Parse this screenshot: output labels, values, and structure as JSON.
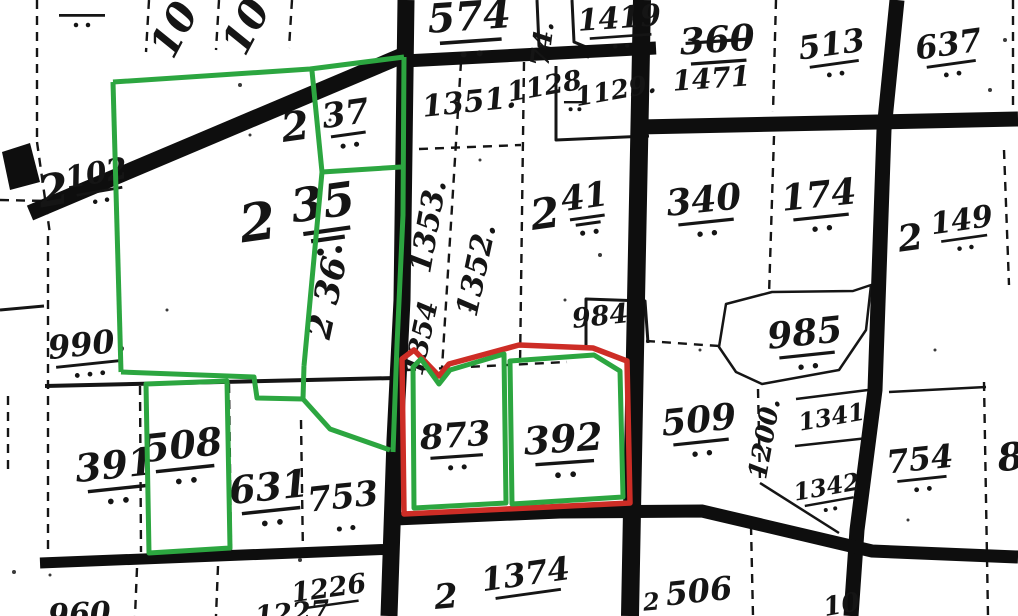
{
  "map": {
    "background": "#ffffff",
    "ink": "#151515",
    "road_color": "#0e0e0e",
    "green": "#2CA640",
    "red": "#CD2D26",
    "labels": [
      {
        "t": "",
        "x": 82,
        "y": 7,
        "fs": 30,
        "rot": 0,
        "u": 1,
        "d": 2,
        "ulw": 50
      },
      {
        "t": "10",
        "x": 186,
        "y": 36,
        "fs": 40,
        "rot": -62,
        "u": 0,
        "d": 0
      },
      {
        "t": "10",
        "x": 258,
        "y": 33,
        "fs": 40,
        "rot": -62,
        "u": 0,
        "d": 0
      },
      {
        "t": "574",
        "x": 470,
        "y": 30,
        "fs": 40,
        "rot": -4,
        "u": 1,
        "d": 2
      },
      {
        "t": "74.",
        "x": 551,
        "y": 45,
        "fs": 26,
        "rot": -83,
        "u": 0,
        "d": 0
      },
      {
        "t": "1419",
        "x": 620,
        "y": 28,
        "fs": 30,
        "rot": -4,
        "u": 1,
        "d": 2
      },
      {
        "t": "360",
        "x": 718,
        "y": 52,
        "fs": 36,
        "rot": -4,
        "u": 1,
        "d": 0,
        "strike": 1
      },
      {
        "t": "1471",
        "x": 712,
        "y": 88,
        "fs": 28,
        "rot": -4,
        "u": 0,
        "d": 0
      },
      {
        "t": "513",
        "x": 833,
        "y": 55,
        "fs": 32,
        "rot": -8,
        "u": 1,
        "d": 2
      },
      {
        "t": "637",
        "x": 950,
        "y": 55,
        "fs": 32,
        "rot": -8,
        "u": 1,
        "d": 2
      },
      {
        "t": "2",
        "x": 56,
        "y": 205,
        "fs": 44,
        "rot": -10,
        "u": 0,
        "d": 0
      },
      {
        "t": "102",
        "x": 98,
        "y": 183,
        "fs": 30,
        "rot": -10,
        "u": 1,
        "d": 2
      },
      {
        "t": "2",
        "x": 260,
        "y": 240,
        "fs": 52,
        "rot": -8,
        "u": 0,
        "d": 0
      },
      {
        "t": "35",
        "x": 325,
        "y": 218,
        "fs": 46,
        "rot": -8,
        "u": 2,
        "d": 2
      },
      {
        "t": "2",
        "x": 297,
        "y": 140,
        "fs": 40,
        "rot": -8,
        "u": 0,
        "d": 0
      },
      {
        "t": "37",
        "x": 347,
        "y": 125,
        "fs": 34,
        "rot": -8,
        "u": 1,
        "d": 2
      },
      {
        "t": "2 36",
        "x": 338,
        "y": 300,
        "fs": 34,
        "rot": -78,
        "u": 0,
        "d": 0
      },
      {
        "t": "1351.",
        "x": 470,
        "y": 112,
        "fs": 30,
        "rot": -6,
        "u": 0,
        "d": 0
      },
      {
        "t": "1128",
        "x": 546,
        "y": 95,
        "fs": 27,
        "rot": -10,
        "u": 0,
        "d": 0
      },
      {
        "t": "",
        "x": 575,
        "y": 96,
        "fs": 22,
        "rot": 0,
        "u": 1,
        "d": 2,
        "ulw": 24
      },
      {
        "t": "1129.",
        "x": 617,
        "y": 99,
        "fs": 26,
        "rot": -10,
        "u": 0,
        "d": 0
      },
      {
        "t": "1353.",
        "x": 438,
        "y": 228,
        "fs": 30,
        "rot": -80,
        "u": 0,
        "d": 0
      },
      {
        "t": "1352.",
        "x": 486,
        "y": 272,
        "fs": 30,
        "rot": -78,
        "u": 0,
        "d": 0
      },
      {
        "t": "1354",
        "x": 430,
        "y": 340,
        "fs": 27,
        "rot": -78,
        "u": 0,
        "d": 0
      },
      {
        "t": "2",
        "x": 547,
        "y": 228,
        "fs": 42,
        "rot": -8,
        "u": 0,
        "d": 0
      },
      {
        "t": "41",
        "x": 586,
        "y": 208,
        "fs": 34,
        "rot": -8,
        "u": 2,
        "d": 2
      },
      {
        "t": "340",
        "x": 705,
        "y": 212,
        "fs": 36,
        "rot": -6,
        "u": 1,
        "d": 2
      },
      {
        "t": "174",
        "x": 820,
        "y": 207,
        "fs": 36,
        "rot": -6,
        "u": 1,
        "d": 2
      },
      {
        "t": "2",
        "x": 912,
        "y": 250,
        "fs": 36,
        "rot": -8,
        "u": 0,
        "d": 0
      },
      {
        "t": "149",
        "x": 963,
        "y": 230,
        "fs": 30,
        "rot": -8,
        "u": 1,
        "d": 2
      },
      {
        "t": "984",
        "x": 601,
        "y": 325,
        "fs": 27,
        "rot": -6,
        "u": 0,
        "d": 0
      },
      {
        "t": "985",
        "x": 806,
        "y": 345,
        "fs": 36,
        "rot": -6,
        "u": 1,
        "d": 2
      },
      {
        "t": "990.",
        "x": 88,
        "y": 355,
        "fs": 32,
        "rot": -6,
        "u": 1,
        "d": 3
      },
      {
        "t": "509",
        "x": 700,
        "y": 432,
        "fs": 36,
        "rot": -6,
        "u": 1,
        "d": 2
      },
      {
        "t": "1200.",
        "x": 773,
        "y": 440,
        "fs": 26,
        "rot": -80,
        "u": 0,
        "d": 0
      },
      {
        "t": "1341",
        "x": 833,
        "y": 425,
        "fs": 24,
        "rot": -10,
        "u": 0,
        "d": 0
      },
      {
        "t": "1342",
        "x": 828,
        "y": 495,
        "fs": 24,
        "rot": -10,
        "u": 1,
        "d": 2
      },
      {
        "t": "754",
        "x": 921,
        "y": 470,
        "fs": 32,
        "rot": -6,
        "u": 1,
        "d": 2
      },
      {
        "t": "8",
        "x": 1012,
        "y": 470,
        "fs": 38,
        "rot": -6,
        "u": 0,
        "d": 0
      },
      {
        "t": "391",
        "x": 116,
        "y": 478,
        "fs": 38,
        "rot": -6,
        "u": 1,
        "d": 2
      },
      {
        "t": "508",
        "x": 184,
        "y": 458,
        "fs": 38,
        "rot": -6,
        "u": 1,
        "d": 2
      },
      {
        "t": "631",
        "x": 270,
        "y": 500,
        "fs": 38,
        "rot": -6,
        "u": 1,
        "d": 2
      },
      {
        "t": "753",
        "x": 344,
        "y": 508,
        "fs": 34,
        "rot": -6,
        "u": 0,
        "d": 2
      },
      {
        "t": "873",
        "x": 456,
        "y": 447,
        "fs": 34,
        "rot": -4,
        "u": 1,
        "d": 2
      },
      {
        "t": "392",
        "x": 564,
        "y": 452,
        "fs": 38,
        "rot": -4,
        "u": 1,
        "d": 2
      },
      {
        "t": "1226",
        "x": 330,
        "y": 597,
        "fs": 27,
        "rot": -8,
        "u": 1,
        "d": 0
      },
      {
        "t": "1227",
        "x": 293,
        "y": 622,
        "fs": 27,
        "rot": -5,
        "u": 0,
        "d": 0
      },
      {
        "t": "960",
        "x": 80,
        "y": 624,
        "fs": 30,
        "rot": -3,
        "u": 0,
        "d": 0
      },
      {
        "t": "2",
        "x": 447,
        "y": 608,
        "fs": 34,
        "rot": -5,
        "u": 0,
        "d": 0
      },
      {
        "t": "1374",
        "x": 527,
        "y": 585,
        "fs": 32,
        "rot": -8,
        "u": 1,
        "d": 0
      },
      {
        "t": "2",
        "x": 652,
        "y": 610,
        "fs": 24,
        "rot": -5,
        "u": 0,
        "d": 0
      },
      {
        "t": "506",
        "x": 700,
        "y": 602,
        "fs": 32,
        "rot": -6,
        "u": 0,
        "d": 0
      },
      {
        "t": "10",
        "x": 843,
        "y": 613,
        "fs": 26,
        "rot": -10,
        "u": 0,
        "d": 0
      }
    ],
    "roads": [
      {
        "d": "M30,213 L406,54",
        "w": 16
      },
      {
        "d": "M406,0 L402,300 L395,440 L389,616",
        "w": 17
      },
      {
        "d": "M642,0 L636,300 L630,616",
        "w": 18
      },
      {
        "d": "M897,0 L884,130 L875,390 L857,530 L851,616",
        "w": 15
      },
      {
        "d": "M404,61 L656,48",
        "w": 13
      },
      {
        "d": "M639,127 L1018,119",
        "w": 15
      },
      {
        "d": "M395,519 L560,512 L702,511 L872,551 L1018,557",
        "w": 13
      },
      {
        "d": "M40,563 L396,549",
        "w": 11
      }
    ],
    "blobs": [
      {
        "d": "M2,152 L30,143 L40,182 L10,190 Z"
      }
    ],
    "solids": [
      {
        "d": "M45,386 L395,378",
        "w": 4
      },
      {
        "d": "M537,0 L539,46 L589,57",
        "w": 3
      },
      {
        "d": "M572,0 L574,42 L591,49",
        "w": 3
      },
      {
        "d": "M556,66 L556,140 L649,136",
        "w": 3
      },
      {
        "d": "M586,345 L586,299 L645,301 L648,343",
        "w": 3
      },
      {
        "d": "M719,347 L726,304 L772,292 L853,291 L871,285 L866,330 L839,370 L762,384 L736,372 Z",
        "w": 2.5
      },
      {
        "d": "M889,392 L986,387",
        "w": 2.5
      },
      {
        "d": "M795,446 L868,438",
        "w": 2.5
      },
      {
        "d": "M760,483 L839,533",
        "w": 2.5
      },
      {
        "d": "M868,390 L796,399",
        "w": 2.5
      },
      {
        "d": "M0,310 L44,306",
        "w": 3
      }
    ],
    "dashed": [
      {
        "d": "M149,0 L146,52"
      },
      {
        "d": "M219,0 L216,50"
      },
      {
        "d": "M292,0 L289,48"
      },
      {
        "d": "M37,0 L37,142"
      },
      {
        "d": "M37,142 L50,234"
      },
      {
        "d": "M48,236 L48,556"
      },
      {
        "d": "M140,386 L141,552"
      },
      {
        "d": "M229,384 L231,550"
      },
      {
        "d": "M301,420 L303,556"
      },
      {
        "d": "M137,568 L135,616"
      },
      {
        "d": "M218,566 L216,616"
      },
      {
        "d": "M419,149 L521,145"
      },
      {
        "d": "M461,62 L442,368"
      },
      {
        "d": "M524,62 L520,366"
      },
      {
        "d": "M407,370 L567,362"
      },
      {
        "d": "M776,0 L773,112"
      },
      {
        "d": "M1013,0 L1013,112"
      },
      {
        "d": "M774,136 L769,295"
      },
      {
        "d": "M646,341 L719,346"
      },
      {
        "d": "M1004,150 L1009,285"
      },
      {
        "d": "M984,382 L988,616"
      },
      {
        "d": "M758,389 L760,482"
      },
      {
        "d": "M751,526 L753,616"
      },
      {
        "d": "M8,396 L8,470"
      },
      {
        "d": "M0,200 L47,201"
      }
    ],
    "greens": [
      {
        "d": "M113,82 L310,69 L404,57"
      },
      {
        "d": "M404,57 L403,215 L397,345 L393,452"
      },
      {
        "d": "M312,71 L322,172"
      },
      {
        "d": "M322,172 L401,167"
      },
      {
        "d": "M322,172 L304,366"
      },
      {
        "d": "M113,82 L121,372"
      },
      {
        "d": "M121,372 L254,377 L257,398 L303,399 L304,366"
      },
      {
        "d": "M303,399 L330,429 L390,450"
      },
      {
        "d": "M146,384 L227,381 L230,548 L149,553 Z"
      },
      {
        "d": "M414,508 L413,367 L421,359 L439,384 L450,370 L504,354 L506,503 Z"
      },
      {
        "d": "M512,504 L510,361 L594,355 L620,371 L623,497 Z"
      }
    ],
    "reds": [
      {
        "d": "M404,514 L402,359 L414,350 L439,376 L449,364 L519,345 L593,348 L627,361 L630,503 Z"
      }
    ],
    "specks": [
      [
        240,
        85,
        2
      ],
      [
        600,
        255,
        2
      ],
      [
        480,
        160,
        1.5
      ],
      [
        300,
        560,
        2
      ],
      [
        50,
        575,
        1.5
      ],
      [
        990,
        90,
        2
      ],
      [
        470,
        310,
        1.5
      ],
      [
        700,
        350,
        1.5
      ],
      [
        14,
        572,
        2
      ],
      [
        330,
        120,
        1.5
      ],
      [
        908,
        520,
        1.5
      ],
      [
        1005,
        40,
        2
      ],
      [
        167,
        310,
        1.5
      ],
      [
        250,
        135,
        1.5
      ],
      [
        565,
        300,
        1.5
      ],
      [
        935,
        350,
        1.5
      ]
    ]
  }
}
